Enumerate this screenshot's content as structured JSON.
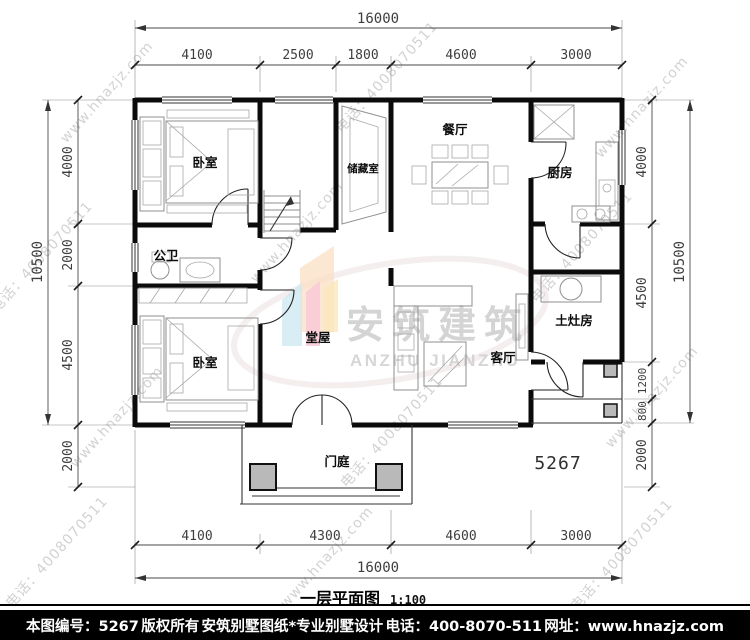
{
  "caption": {
    "title": "一层平面图",
    "scale": "1:100"
  },
  "plan_number": "5267",
  "logo": {
    "cn": "安筑建筑",
    "en": "ANZHU JIANZHU"
  },
  "watermark": {
    "phone": "电话：4008070511",
    "site": "www.hnazjz.com"
  },
  "rooms": {
    "bedroom_top": "卧室",
    "storage": "储藏室",
    "dining": "餐厅",
    "kitchen": "厨房",
    "bath": "公卫",
    "bedroom_bottom": "卧室",
    "hall": "堂屋",
    "living": "客厅",
    "stove": "土灶房",
    "porch": "门庭"
  },
  "dims": {
    "top_total": "16000",
    "top_segments": [
      "4100",
      "2500",
      "1800",
      "4600",
      "3000"
    ],
    "bottom_segments": [
      "4100",
      "4300",
      "4600",
      "3000"
    ],
    "bottom_total": "16000",
    "left_total": "10500",
    "left_segments": [
      "4000",
      "2000",
      "4500",
      "2000"
    ],
    "right_segments": [
      "4000",
      "4500",
      "1200",
      "800",
      "2000"
    ],
    "right_total": "10500"
  },
  "footer": {
    "number_label": "本图编号：5267",
    "copyright": "版权所有",
    "company": "安筑别墅图纸*专业别墅设计",
    "phone": "电话：400-8070-511",
    "website": "网址：www.hnazjz.com"
  },
  "colors": {
    "wall": "#0b0b0b",
    "dimension_text": "#3d3d3d",
    "watermark_gray": "#b5b5b5",
    "logo_peach": "#fbdfc4",
    "logo_blue": "#cfe9f1",
    "logo_pink": "#f8c9d6",
    "logo_yellow": "#fae9bd",
    "footer_bg": "#000000"
  }
}
